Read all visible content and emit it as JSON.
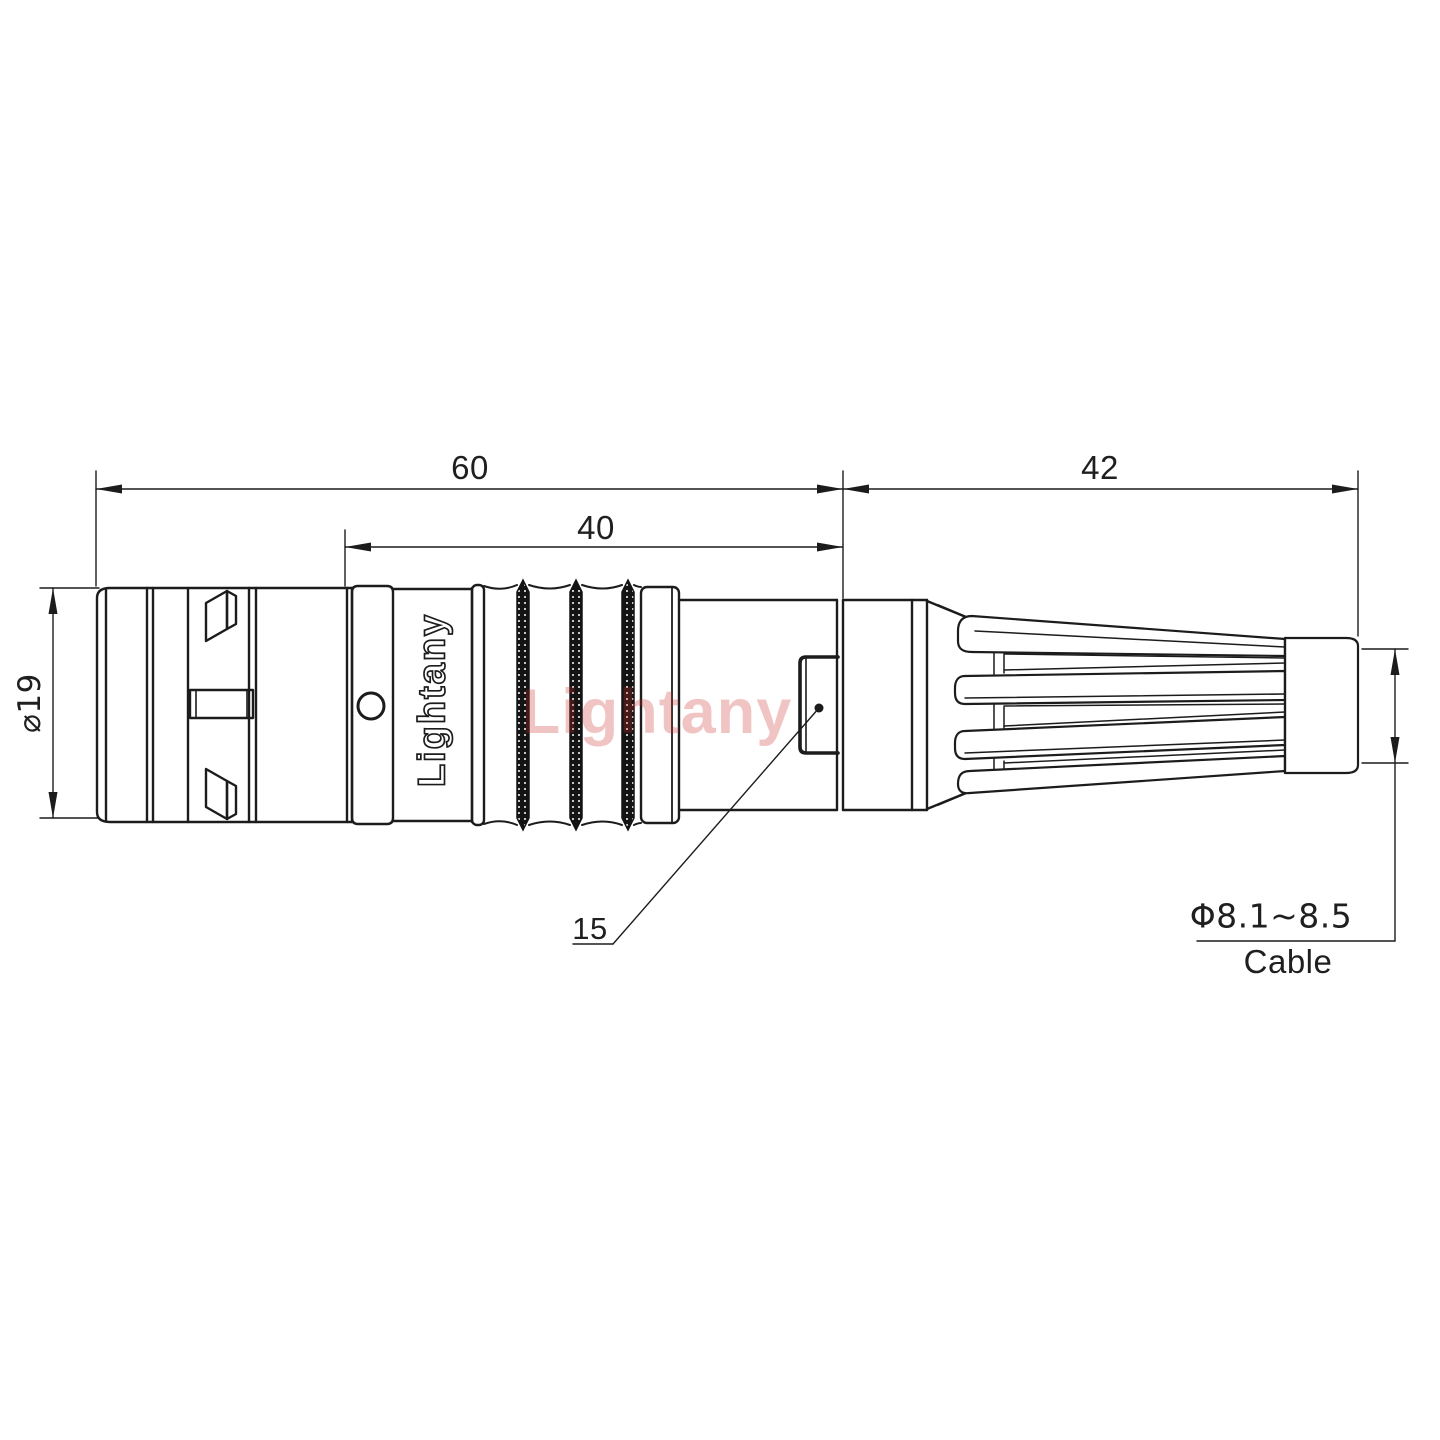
{
  "drawing": {
    "type": "connector-technical-drawing",
    "dimensions": {
      "overall_length": "60",
      "mid_length": "40",
      "rear_length": "42",
      "front_diameter": "⌀19",
      "detail_callout": "15",
      "cable_diameter": "Φ8.1~8.5",
      "cable_label": "Cable"
    },
    "branding": {
      "body_text": "Lightany",
      "watermark": "Lightany"
    },
    "colors": {
      "line": "#1c1c1c",
      "watermark": "#cb2c2c",
      "background": "#ffffff"
    }
  }
}
